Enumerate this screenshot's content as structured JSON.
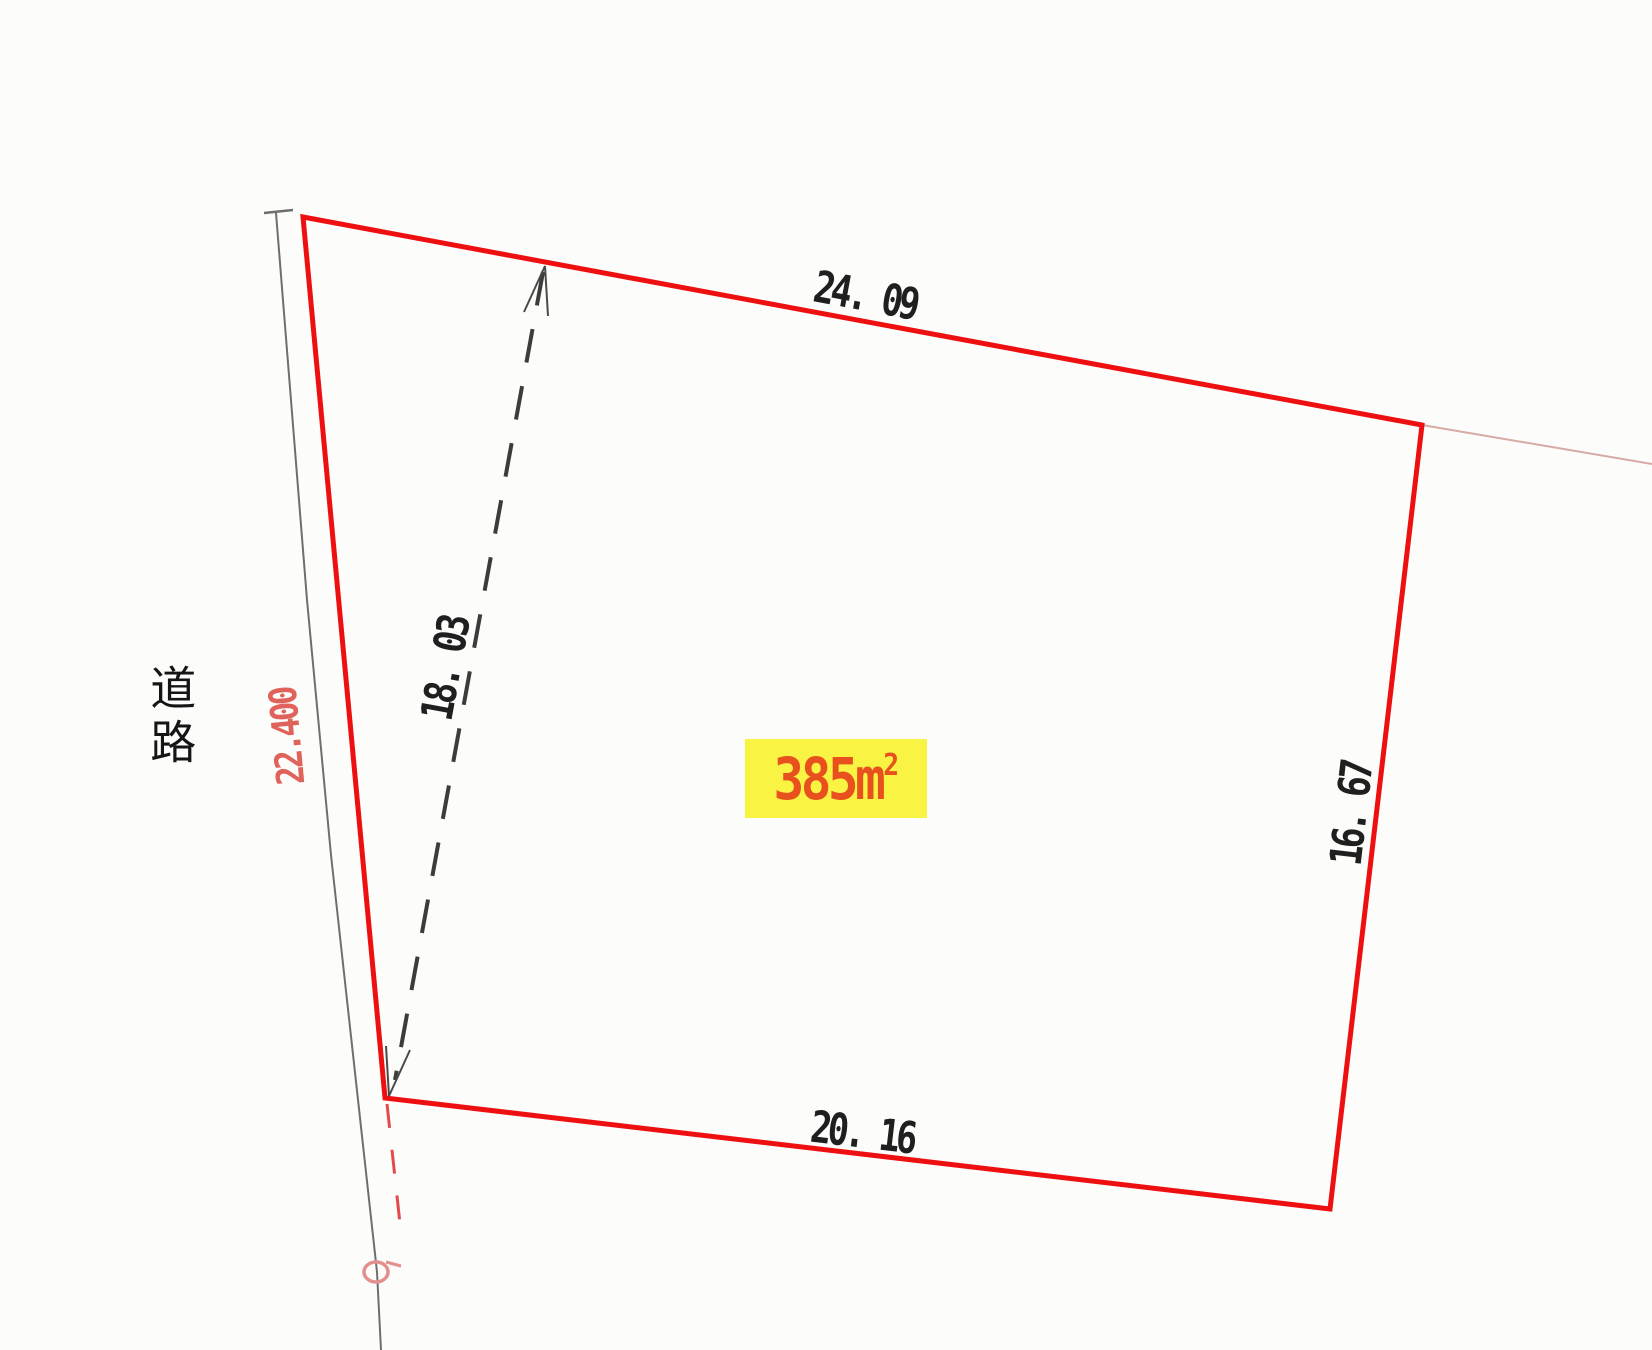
{
  "parcel_map": {
    "road_label": "道路",
    "road_frontage_label": "22.400",
    "dimensions": {
      "top_edge": "24. 09",
      "right_edge": "16. 67",
      "bottom_edge": "20. 16",
      "diagonal": "18. 03"
    },
    "area_badge": {
      "full_text": "385㎡",
      "value": "385m",
      "superscript": "2",
      "text_color": "#e8511d",
      "highlight_color": "#f9f344"
    },
    "colors": {
      "parcel_boundary": "#ee1010",
      "road_line": "#6e6e6e",
      "dimension_text": "#1f1f1f",
      "road_frontage_text": "#e0635b",
      "diagonal_measure_dash": "#3c3c3c",
      "aux_dashed_red": "#e24b4b",
      "survey_marker": "#e2908e",
      "boundary_extension": "#d8aaa6"
    }
  }
}
